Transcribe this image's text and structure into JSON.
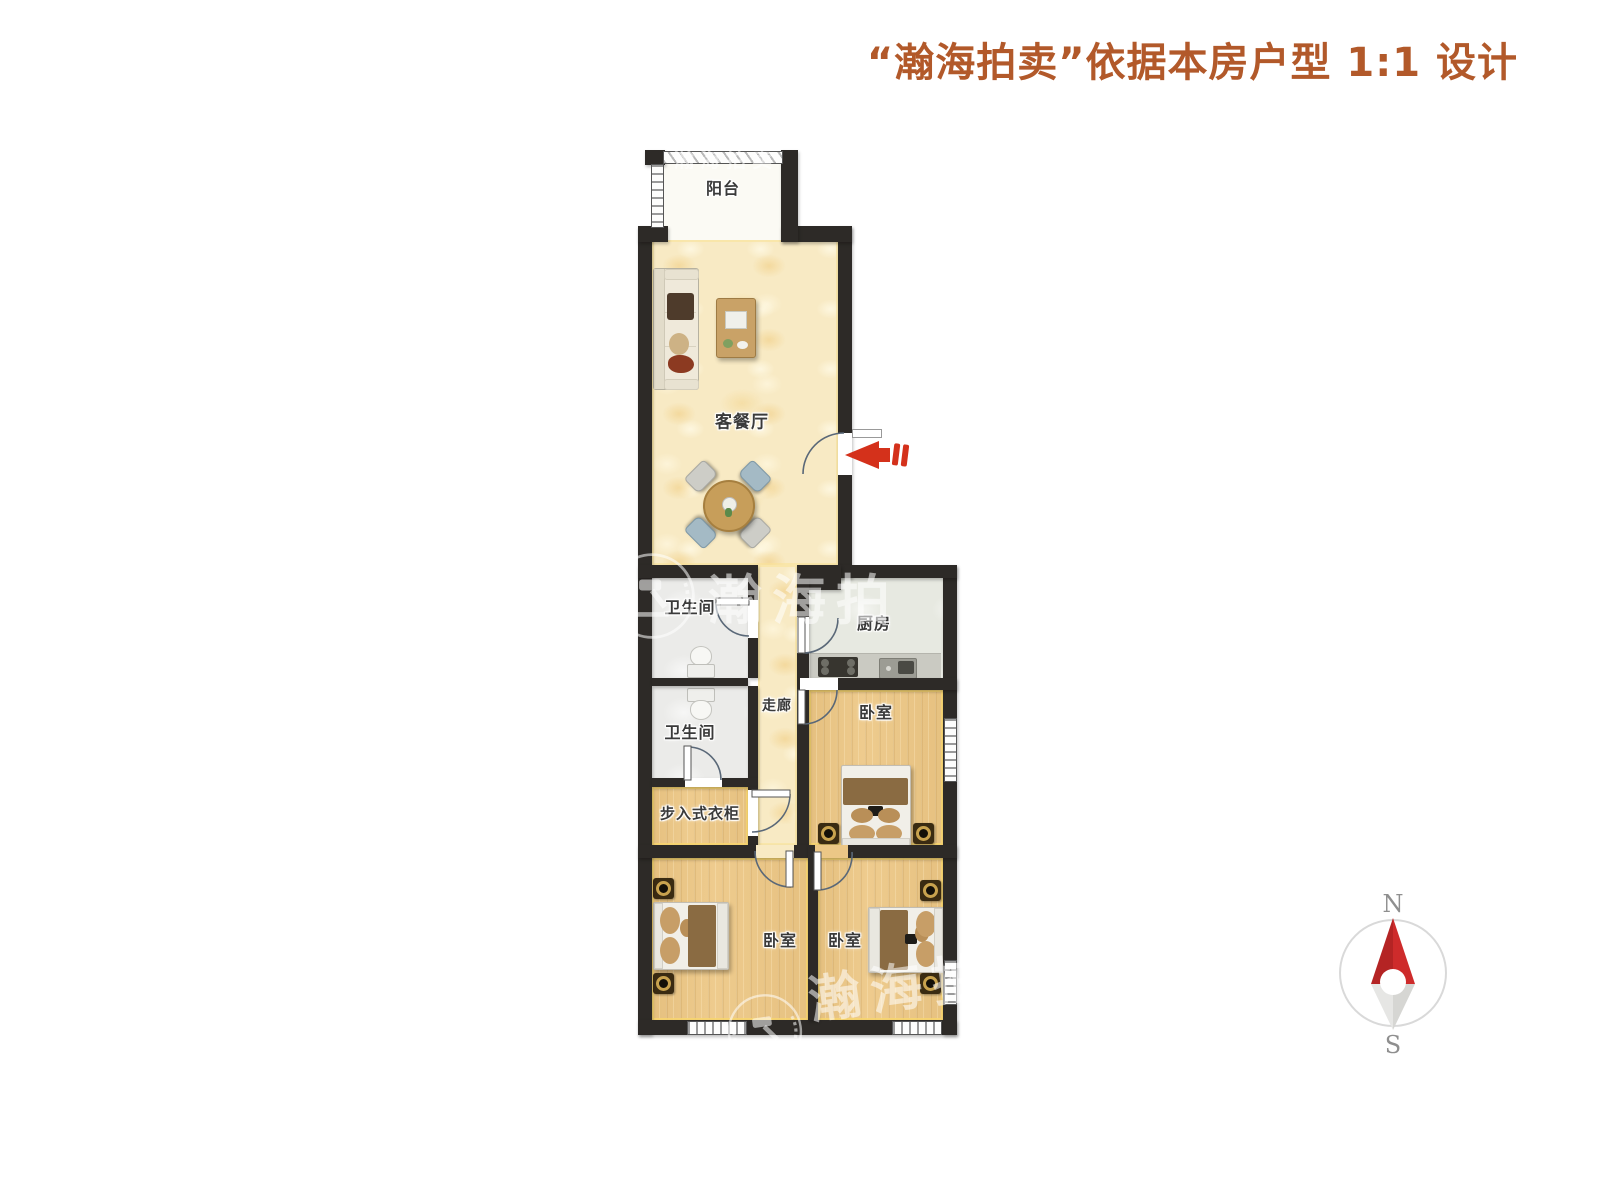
{
  "header": {
    "title": "“瀚海拍卖”依据本房户型 1:1 设计"
  },
  "floor_plan": {
    "rooms": {
      "balcony": "阳台",
      "living_dining": "客餐厅",
      "bathroom_upper": "卫生间",
      "bathroom_lower": "卫生间",
      "kitchen": "厨房",
      "corridor": "走廊",
      "walk_in_closet": "步入式衣柜",
      "bedroom_middle": "卧室",
      "bedroom_bottom_left": "卧室",
      "bedroom_bottom_right": "卧室"
    }
  },
  "compass": {
    "north_label": "N",
    "south_label": "S"
  },
  "watermark": {
    "brand_text": "瀚海拍",
    "brand_text_full": "瀚海拍卖"
  },
  "colors": {
    "title_text": "#B2592A",
    "wall": "#2D2A27",
    "entrance_arrow": "#D4311B",
    "compass_north": "#C52B2B",
    "cream_floor": "#F8EAC4",
    "wood_floor": "#ECC786",
    "bath_floor": "#EBEBE9",
    "kitchen_floor": "#E7E9E1",
    "balcony_floor": "#FBFAF4"
  }
}
